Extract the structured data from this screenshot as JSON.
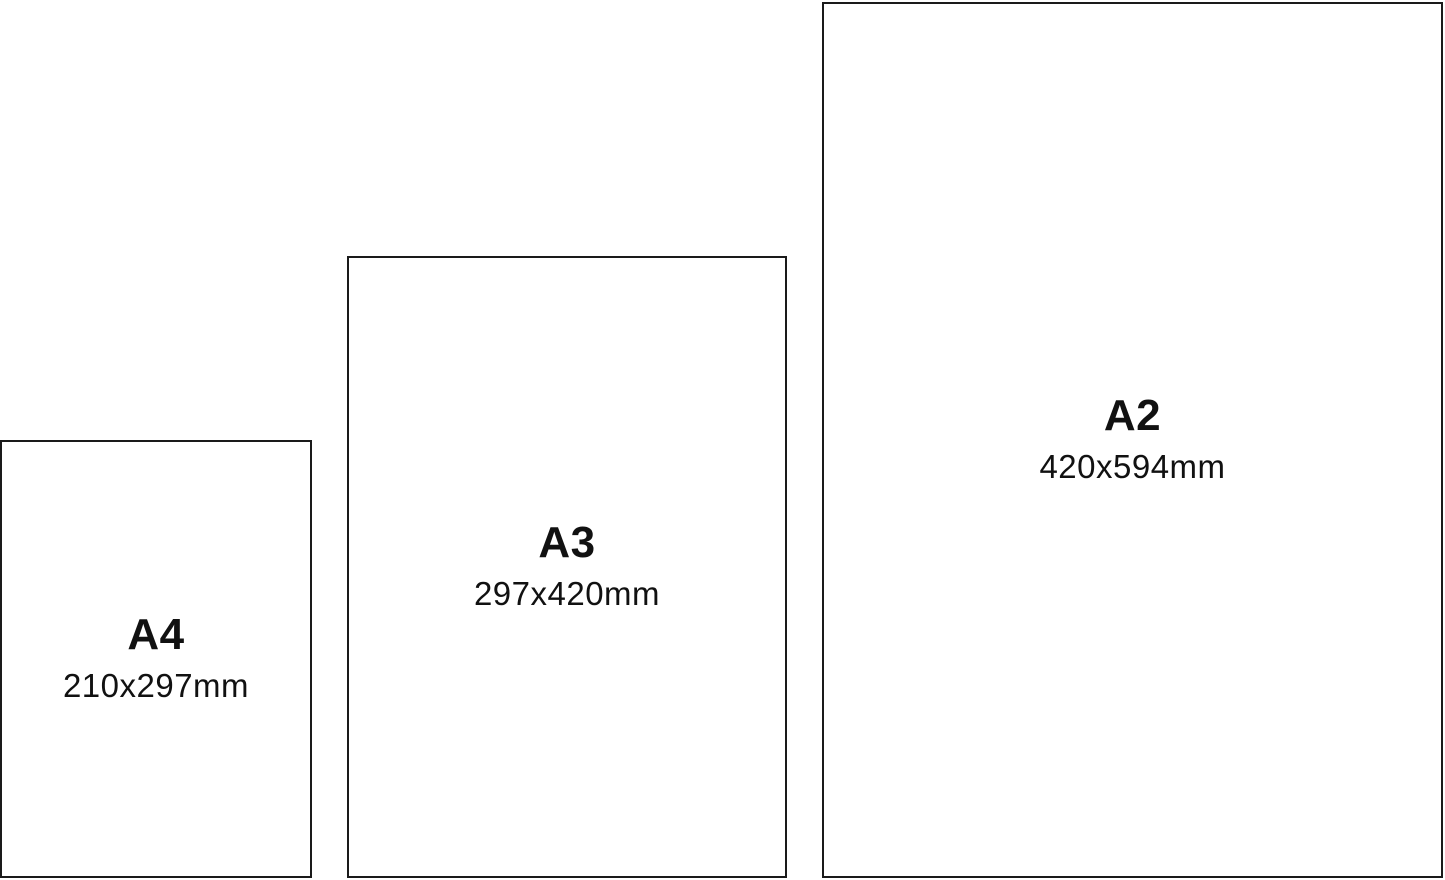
{
  "diagram": {
    "description": "Paper size comparison",
    "ink_color": "#1a1a1a",
    "background_color": "#ffffff",
    "sizes": [
      {
        "label": "A4",
        "dimensions": "210x297mm"
      },
      {
        "label": "A3",
        "dimensions": "297x420mm"
      },
      {
        "label": "A2",
        "dimensions": "420x594mm"
      }
    ]
  }
}
